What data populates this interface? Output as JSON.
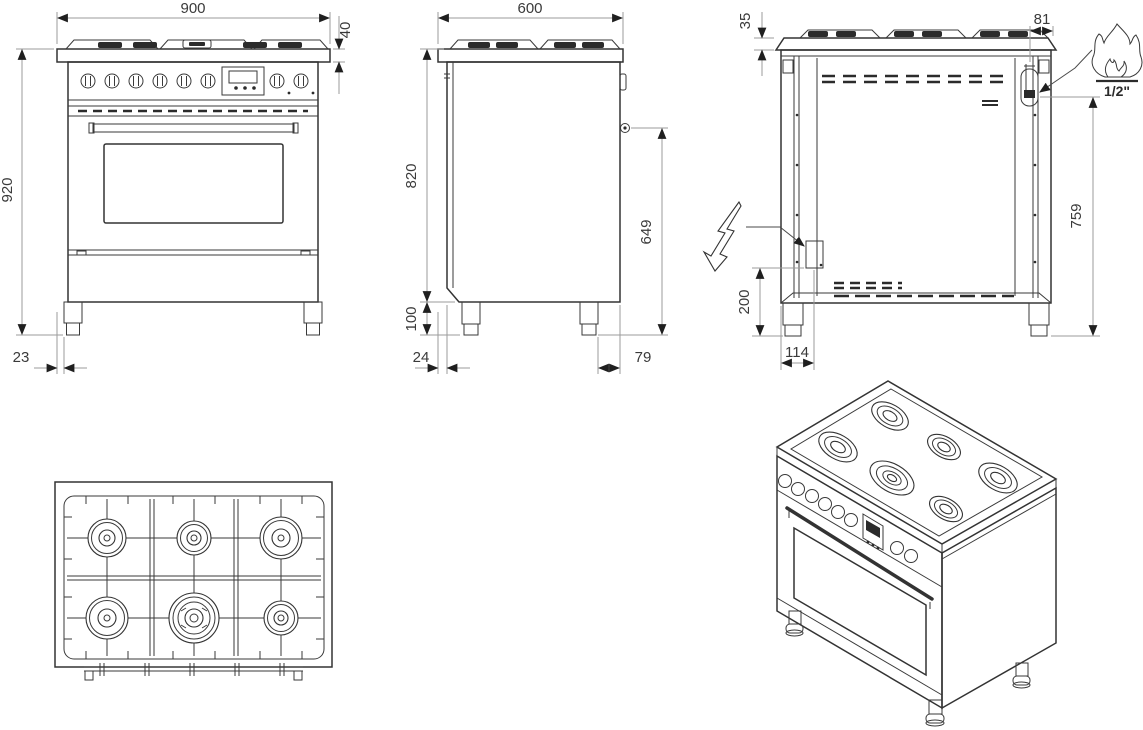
{
  "drawing": {
    "type": "appliance-installation-drawing",
    "subject": "6-burner gas range cooker, four orthographic views plus isometric",
    "colors": {
      "background": "#ffffff",
      "line": "#333333",
      "dimension_line": "#9b9b9b",
      "dimension_text": "#3a3a3a"
    },
    "front_view": {
      "dimensions": {
        "overall_width_mm": "900",
        "cooktop_edge_height_mm": "40",
        "overall_height_mm": "920",
        "side_clearance_mm": "23"
      }
    },
    "side_view": {
      "dimensions": {
        "overall_depth_mm": "600",
        "body_height_mm": "820",
        "gas_inlet_height_mm": "649",
        "plinth_height_mm": "100",
        "front_overhang_mm": "24",
        "rear_leg_inset_mm": "79"
      }
    },
    "rear_view": {
      "dimensions": {
        "top_edge_mm": "35",
        "gas_inlet_offset_mm": "81",
        "gas_inlet_height_mm": "759",
        "electric_inlet_height_mm": "200",
        "electric_inlet_offset_mm": "114"
      },
      "gas_connection_label": "1/2\"",
      "icons": {
        "gas": "flame-icon",
        "electricity": "lightning-bolt-icon"
      }
    },
    "top_view": {
      "burner_count": 6
    },
    "isometric_view": {
      "burner_count": 6
    }
  }
}
